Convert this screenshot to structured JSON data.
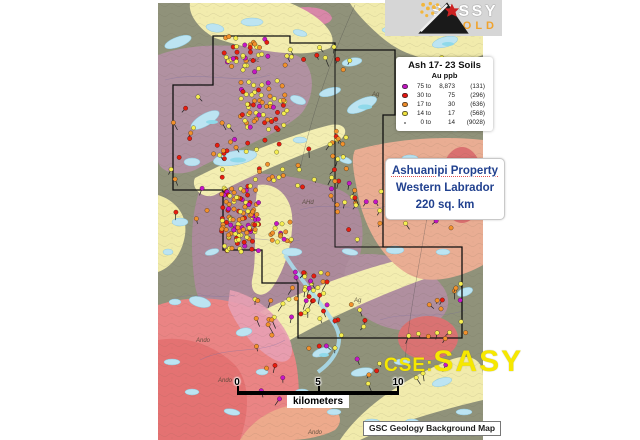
{
  "logo": {
    "name": "SASSY",
    "sub": "GOLD"
  },
  "legend": {
    "title": "Ash 17- 23 Soils",
    "subtitle": "Au ppb",
    "rows": [
      {
        "swatch": "#c414c4",
        "low": "75 to",
        "high": "8,873",
        "count": "(131)"
      },
      {
        "swatch": "#e81410",
        "low": "30 to",
        "high": "75",
        "count": "(296)"
      },
      {
        "swatch": "#f08c28",
        "low": "17 to",
        "high": "30",
        "count": "(636)"
      },
      {
        "swatch": "#f2e43e",
        "low": "14 to",
        "high": "17",
        "count": "(568)"
      },
      {
        "swatch": "none",
        "low": "0 to",
        "high": "14",
        "count": "(9028)"
      }
    ]
  },
  "property": {
    "line1": "Ashuanipi Property",
    "line2": "Western Labrador",
    "line3": "220 sq. km"
  },
  "ticker": {
    "prefix": "CSE:",
    "symbol": "SASY"
  },
  "scalebar": {
    "ticks": [
      "0",
      "5",
      "10"
    ],
    "unit": "kilometers"
  },
  "attribution": {
    "text": "GSC Geology Background Map"
  },
  "map": {
    "colors": {
      "yellow": "#f6ee52",
      "orange": "#f2912c",
      "red": "#e61e10",
      "magenta": "#c616c6"
    },
    "weights": {
      "yellow": 0.36,
      "orange": 0.3,
      "red": 0.22,
      "magenta": 0.12
    },
    "boundary": "M213,36 H290 V43 H335 V50 H395 V115 H383 V247 H462 V338 H298 V283 H262 V250 H223 V190 H173 V85 H213 Z",
    "boundary_inner": "M335,50 V247 H383",
    "geology_labels": [
      {
        "t": "Ando",
        "x": 218,
        "y": 382
      },
      {
        "t": "Ando",
        "x": 196,
        "y": 342
      },
      {
        "t": "Ando",
        "x": 308,
        "y": 434
      },
      {
        "t": "AHd",
        "x": 302,
        "y": 204
      },
      {
        "t": "Ag",
        "x": 354,
        "y": 302
      },
      {
        "t": "AHc",
        "x": 248,
        "y": 62
      },
      {
        "t": "Ag",
        "x": 372,
        "y": 96
      }
    ],
    "clusters": [
      {
        "x": 224,
        "y": 36,
        "w": 44,
        "h": 36,
        "n": 38
      },
      {
        "x": 240,
        "y": 78,
        "w": 50,
        "h": 52,
        "n": 60
      },
      {
        "x": 208,
        "y": 120,
        "w": 30,
        "h": 40,
        "n": 10,
        "stems": true
      },
      {
        "x": 221,
        "y": 186,
        "w": 38,
        "h": 66,
        "n": 115
      },
      {
        "x": 266,
        "y": 220,
        "w": 28,
        "h": 22,
        "n": 16
      },
      {
        "x": 286,
        "y": 272,
        "w": 44,
        "h": 44,
        "n": 30,
        "stems": true
      },
      {
        "x": 330,
        "y": 120,
        "w": 26,
        "h": 95,
        "n": 20,
        "stems": true
      },
      {
        "x": 285,
        "y": 42,
        "w": 65,
        "h": 28,
        "n": 12,
        "stems": true
      },
      {
        "x": 400,
        "y": 55,
        "w": 75,
        "h": 60,
        "n": 12,
        "stems": true
      },
      {
        "x": 415,
        "y": 280,
        "w": 55,
        "h": 60,
        "n": 14,
        "stems": true
      },
      {
        "x": 165,
        "y": 95,
        "w": 45,
        "h": 150,
        "n": 13,
        "stems": true
      },
      {
        "x": 250,
        "y": 295,
        "w": 115,
        "h": 55,
        "n": 26,
        "stems": true
      },
      {
        "x": 345,
        "y": 185,
        "w": 115,
        "h": 55,
        "n": 16,
        "stems": true
      },
      {
        "x": 222,
        "y": 136,
        "w": 62,
        "h": 46,
        "n": 20
      },
      {
        "x": 295,
        "y": 135,
        "w": 55,
        "h": 55,
        "n": 12,
        "stems": true
      },
      {
        "x": 350,
        "y": 330,
        "w": 110,
        "h": 60,
        "n": 10,
        "stems": true
      },
      {
        "x": 250,
        "y": 355,
        "w": 60,
        "h": 50,
        "n": 6,
        "stems": true
      }
    ]
  }
}
